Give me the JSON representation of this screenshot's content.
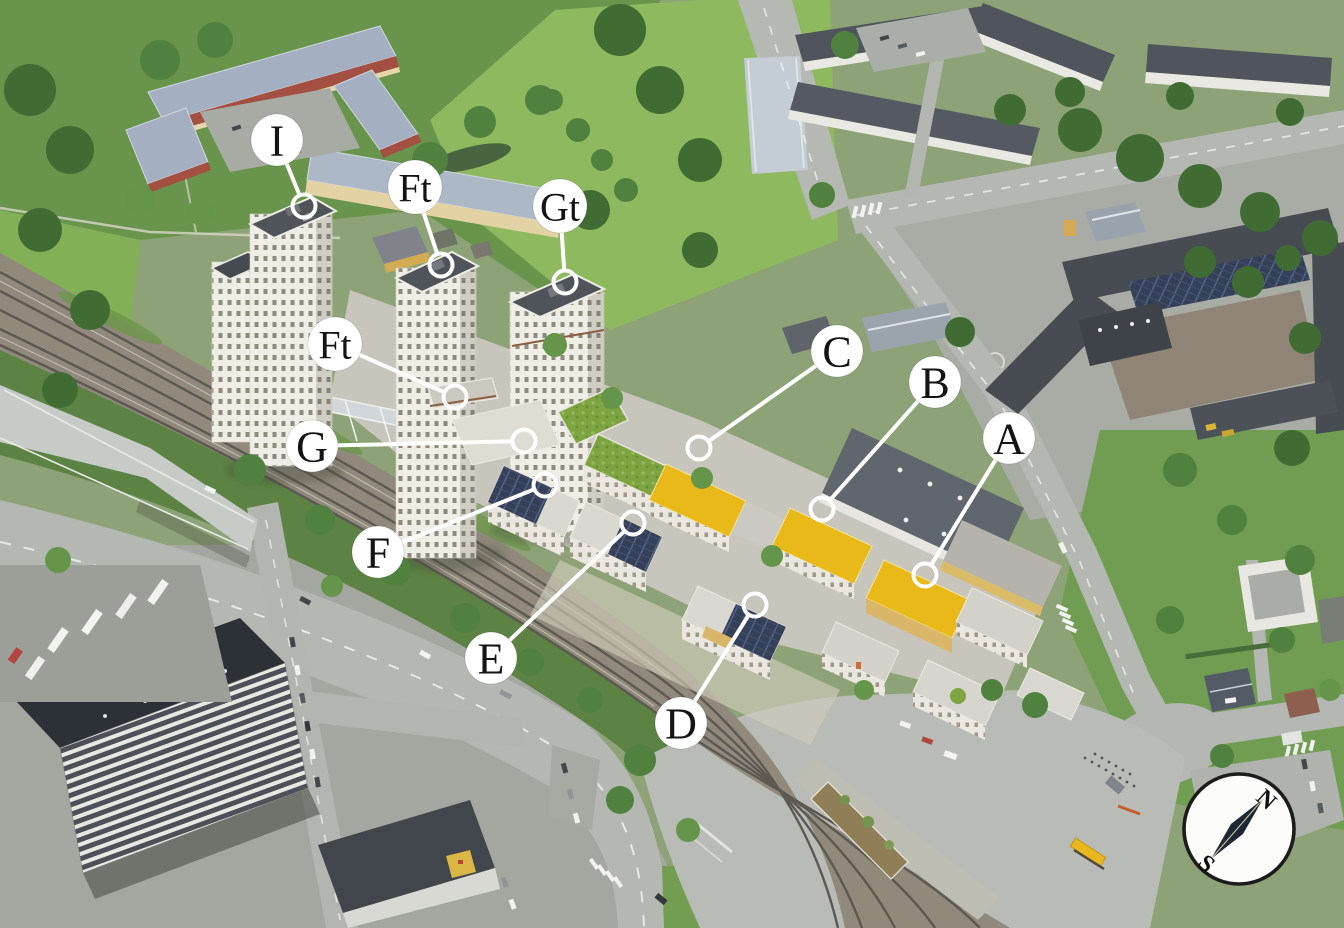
{
  "annotations": {
    "style": {
      "label_circle_fill": "#ffffff",
      "label_text_color": "#141414",
      "leader_line_color": "#ffffff",
      "marker_ring_color": "#ffffff"
    },
    "items": [
      {
        "id": "I",
        "label": "I",
        "label_x": 277,
        "label_y": 140,
        "marker_x": 304,
        "marker_y": 206
      },
      {
        "id": "Ft1",
        "label": "Ft",
        "label_x": 415,
        "label_y": 187,
        "marker_x": 441,
        "marker_y": 265
      },
      {
        "id": "Gt",
        "label": "Gt",
        "label_x": 560,
        "label_y": 206,
        "marker_x": 565,
        "marker_y": 282
      },
      {
        "id": "Ft2",
        "label": "Ft",
        "label_x": 335,
        "label_y": 344,
        "marker_x": 455,
        "marker_y": 397
      },
      {
        "id": "G",
        "label": "G",
        "label_x": 312,
        "label_y": 446,
        "marker_x": 524,
        "marker_y": 441
      },
      {
        "id": "C",
        "label": "C",
        "label_x": 837,
        "label_y": 351,
        "marker_x": 699,
        "marker_y": 448
      },
      {
        "id": "B",
        "label": "B",
        "label_x": 935,
        "label_y": 382,
        "marker_x": 822,
        "marker_y": 509
      },
      {
        "id": "A",
        "label": "A",
        "label_x": 1009,
        "label_y": 438,
        "marker_x": 925,
        "marker_y": 575
      },
      {
        "id": "F",
        "label": "F",
        "label_x": 378,
        "label_y": 552,
        "marker_x": 545,
        "marker_y": 485
      },
      {
        "id": "E",
        "label": "E",
        "label_x": 491,
        "label_y": 658,
        "marker_x": 633,
        "marker_y": 523
      },
      {
        "id": "D",
        "label": "D",
        "label_x": 681,
        "label_y": 723,
        "marker_x": 755,
        "marker_y": 605
      }
    ]
  },
  "compass": {
    "north_label": "N",
    "south_label": "S"
  },
  "palette": {
    "yellow_roof": "#e9b713",
    "ochre_facade": "#d9b564",
    "sedum_green_roof": "#7aa23c",
    "solar_panel_roof": "#2f3a52",
    "grass_field": "#8cb75a",
    "asphalt": "#b2b5b0",
    "railway_bed": "#8d8678",
    "dark_roof": "#474c53",
    "bus_yellow": "#e8b517",
    "compass_needle": "#1d2836"
  }
}
